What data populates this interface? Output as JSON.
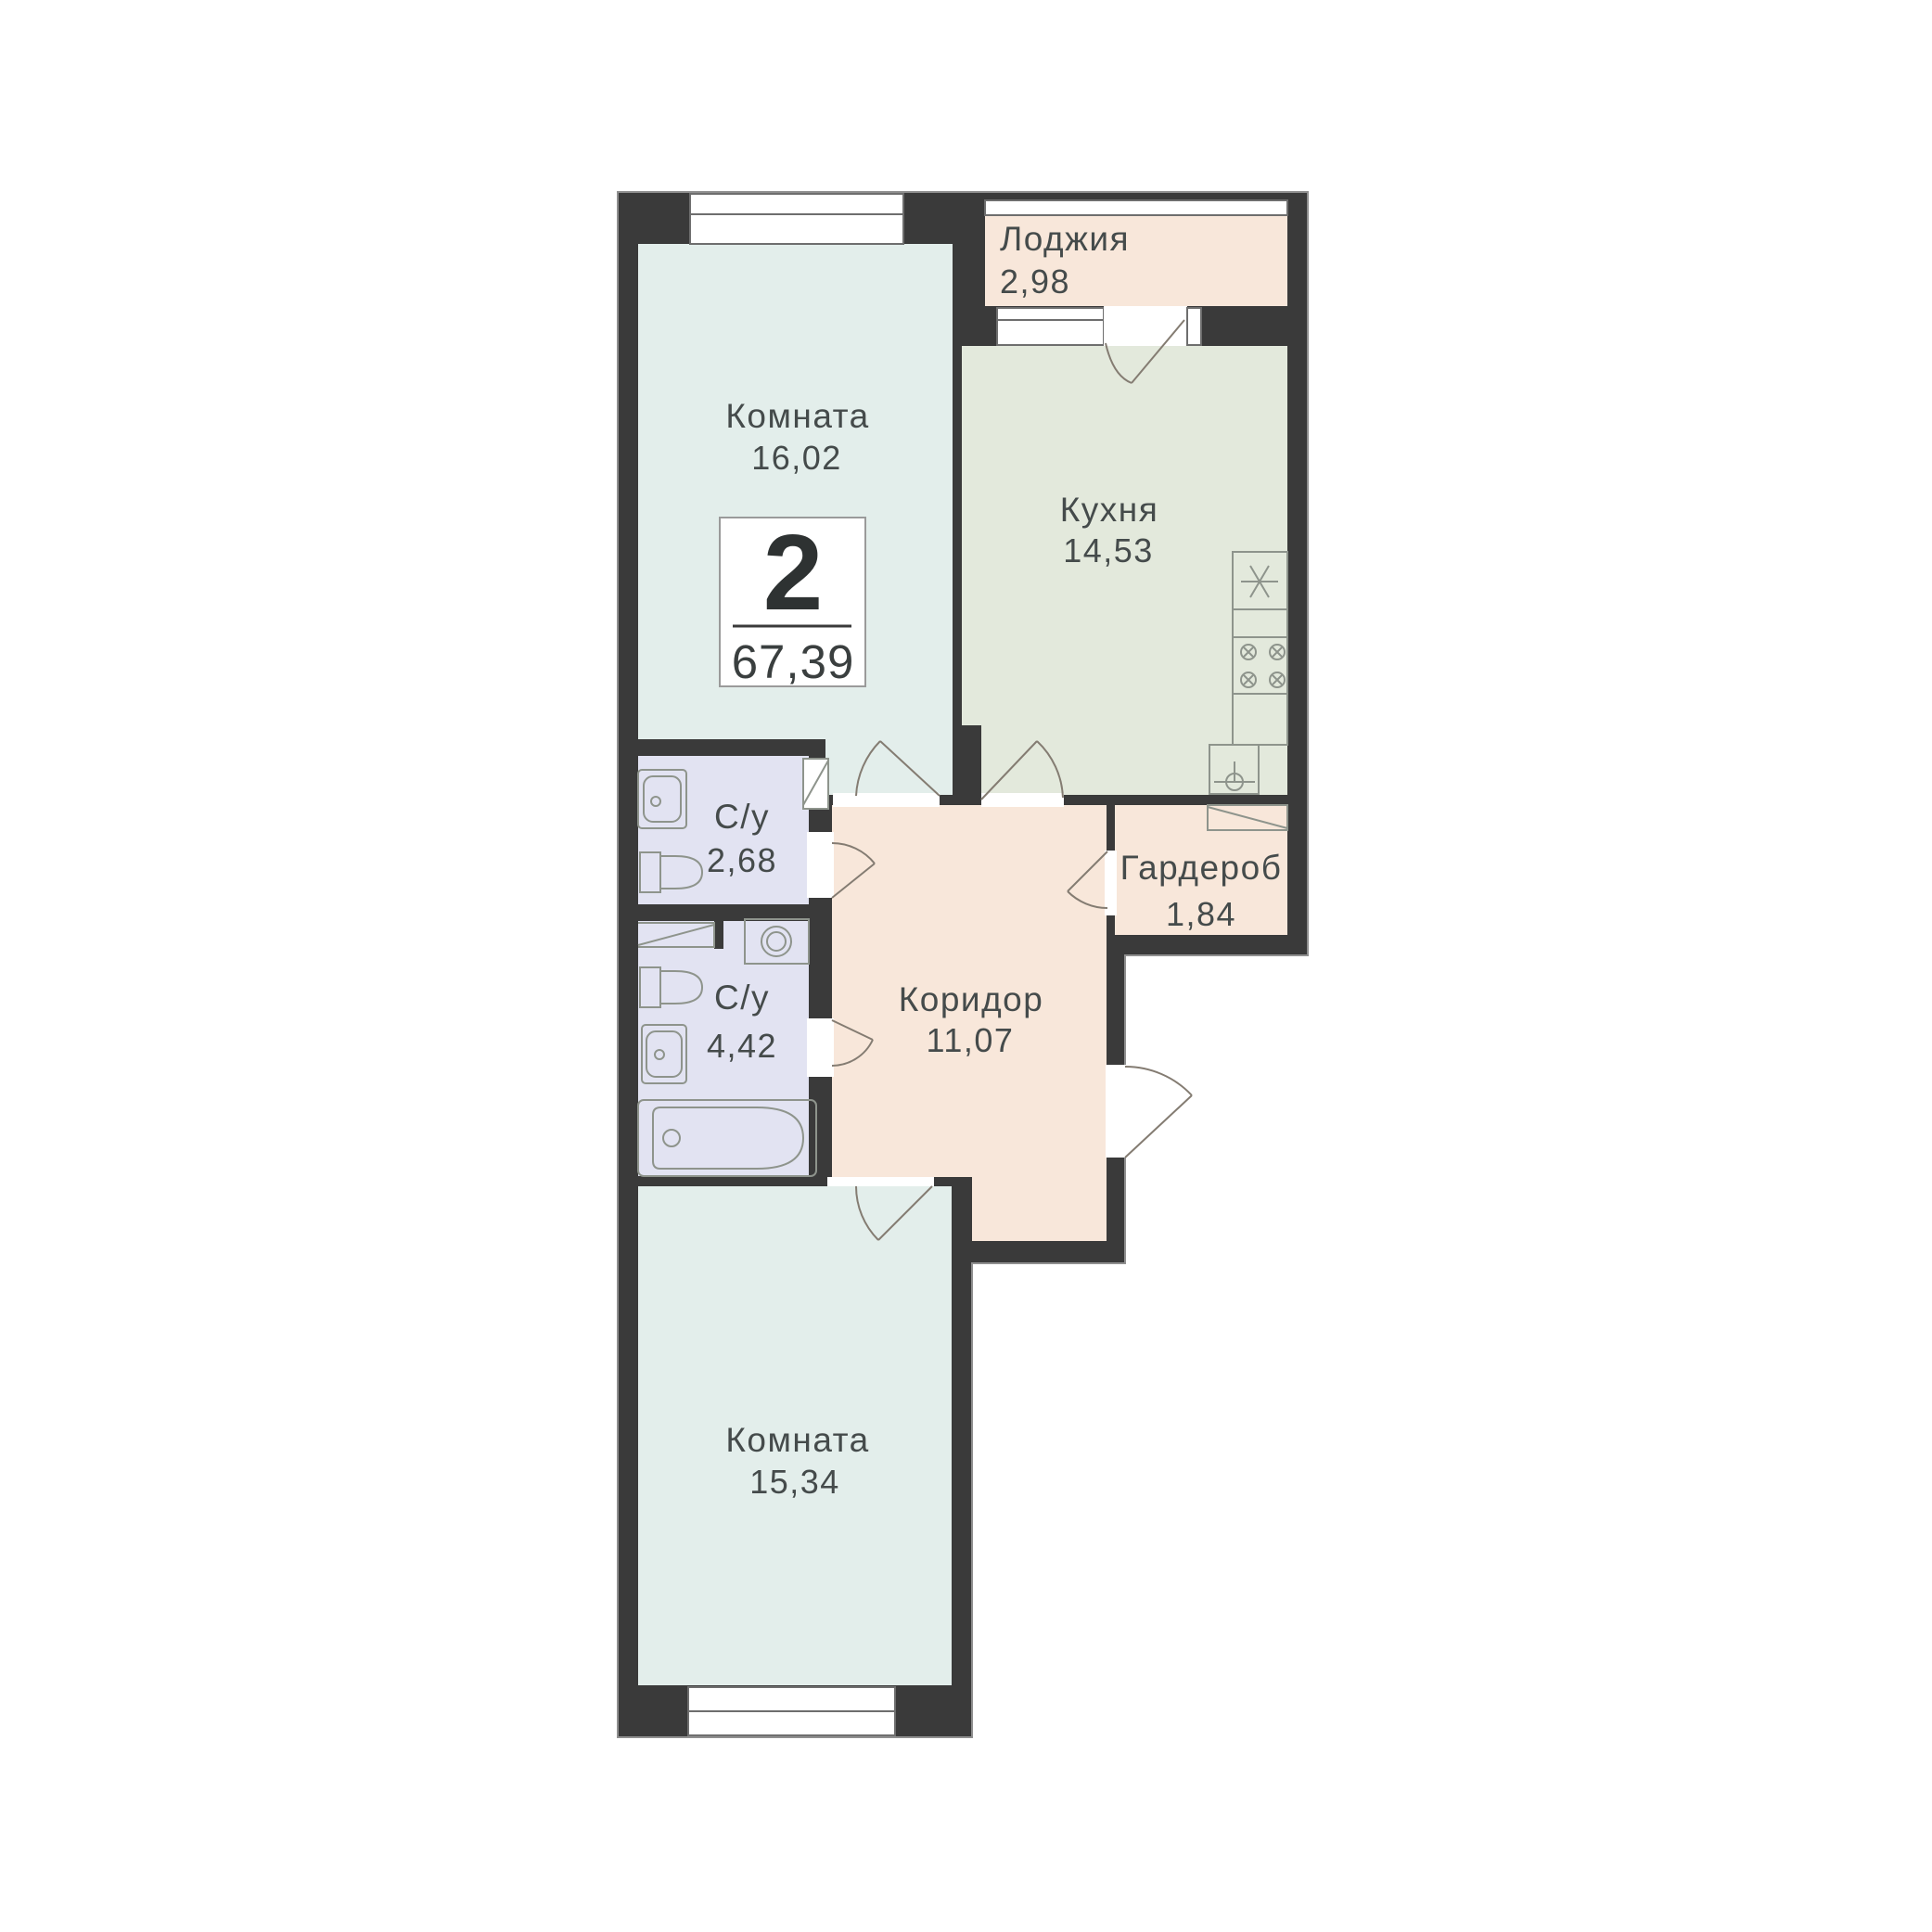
{
  "badge": {
    "room_count": "2",
    "total_area": "67,39"
  },
  "rooms": {
    "room1": {
      "name": "Комната",
      "area": "16,02"
    },
    "kitchen": {
      "name": "Кухня",
      "area": "14,53"
    },
    "loggia": {
      "name": "Лоджия",
      "area": "2,98"
    },
    "bath1": {
      "name": "С/у",
      "area": "2,68"
    },
    "wardrobe": {
      "name": "Гардероб",
      "area": "1,84"
    },
    "bath2": {
      "name": "С/у",
      "area": "4,42"
    },
    "corridor": {
      "name": "Коридор",
      "area": "11,07"
    },
    "room2": {
      "name": "Комната",
      "area": "15,34"
    }
  },
  "colors": {
    "wall": "#3a3a3a",
    "outline": "#8f8f8f",
    "living": "#e3eeeb",
    "kitchen": "#e3e9dc",
    "warm": "#f8e7da",
    "bath": "#e2e3f2",
    "fixture": "#8e948c",
    "door": "#847c72",
    "text": "#454b4b"
  },
  "icons": {
    "fixtures": [
      "bathroom-sink-icon",
      "toilet-icon",
      "washing-machine-icon",
      "bathtub-icon",
      "kitchen-sink-icon",
      "stove-burners-icon",
      "shelf-icon",
      "counter-icon",
      "door-swing-icon",
      "window-icon"
    ]
  }
}
